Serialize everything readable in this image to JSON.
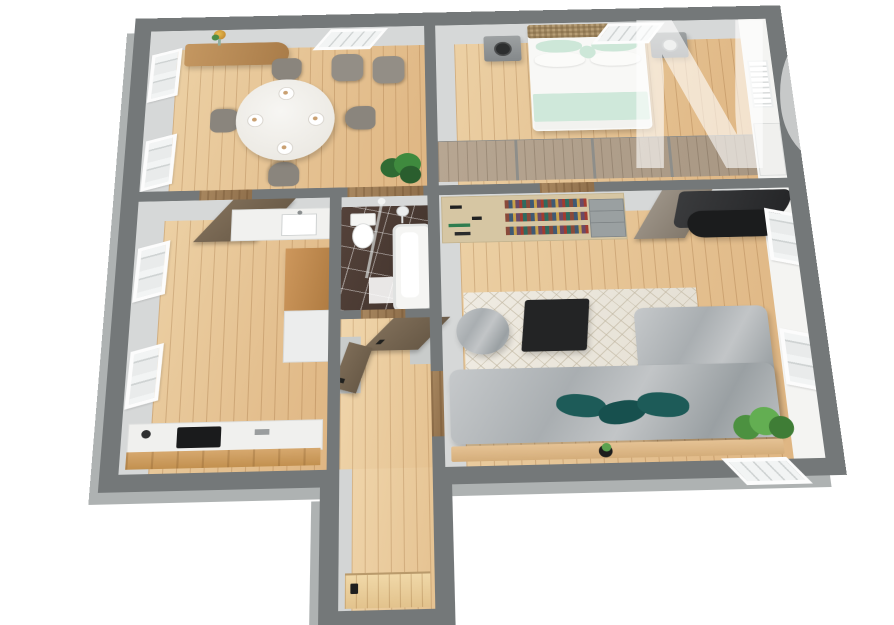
{
  "watermark": {
    "text": "NÓ"
  },
  "scene": {
    "type": "3d-floor-plan-render",
    "view": "isometric top-down apartment",
    "background": "#ffffff",
    "palette": {
      "wall_top": "#747879",
      "wall_bevel": "#aeb2b2",
      "wall_inner_gray": "#d3d5d5",
      "wall_inner_white": "#f4f4f2",
      "floor_oak": "#e5c291",
      "floor_oak_light": "#f0d6ac",
      "bathroom_tile": "#4a3a32",
      "bed_white": "#f8f8f6",
      "bed_mint": "#cfe8da",
      "headboard_wicker": "#b79e76",
      "sofa_marble_gray": "#b3b7b9",
      "cushion_teal": "#1d5b58",
      "rug_cream": "#eae6dc",
      "black_furniture": "#1e1f20",
      "oak_furniture": "#c28a50",
      "sideboard_oak": "#b98b56",
      "shelf_wood": "#d6c6a3",
      "chair_gray": "#8a857d",
      "plant_green": "#4c9140",
      "counter_white": "#f0f0ee",
      "door_wood": "#6e5f4e"
    },
    "rooms": [
      {
        "name": "dining-room",
        "windows": 3,
        "furniture": [
          "sideboard-with-vase",
          "round-dining-table",
          "dining-chairs-x4",
          "place-settings-x4",
          "armchairs-x2",
          "potted-plant"
        ]
      },
      {
        "name": "bedroom",
        "windows": 1,
        "furniture": [
          "double-bed-wicker-headboard",
          "nightstand-left-dark-lamp",
          "nightstand-right-light-lamp",
          "radiator",
          "wardrobe-run",
          "white-wardrobe"
        ]
      },
      {
        "name": "kitchen",
        "windows": 2,
        "furniture": [
          "open-door",
          "upper-cabinet-with-sink",
          "tall-oak-cabinet",
          "base-cabinet",
          "counter-with-black-cooktop"
        ]
      },
      {
        "name": "bathroom",
        "windows": 0,
        "furniture": [
          "toilet",
          "shower-glass-panel",
          "shower-head",
          "bathtub",
          "bath-mat"
        ]
      },
      {
        "name": "hallway",
        "windows": 0,
        "furniture": [
          "open-door-to-bathroom",
          "open-door-to-kitchen"
        ]
      },
      {
        "name": "living-room",
        "windows": 3,
        "furniture": [
          "wall-unit-bookshelf",
          "drawer-unit",
          "open-door",
          "black-curved-lounger",
          "black-ottoman",
          "diamond-rug",
          "black-coffee-table",
          "marble-pouf",
          "marble-corner-sofa",
          "teal-cushions-x3",
          "wooden-console",
          "small-plant",
          "large-plant"
        ]
      },
      {
        "name": "entry-corridor",
        "windows": 0,
        "furniture": [
          "entry-door-with-black-handle"
        ]
      }
    ]
  }
}
